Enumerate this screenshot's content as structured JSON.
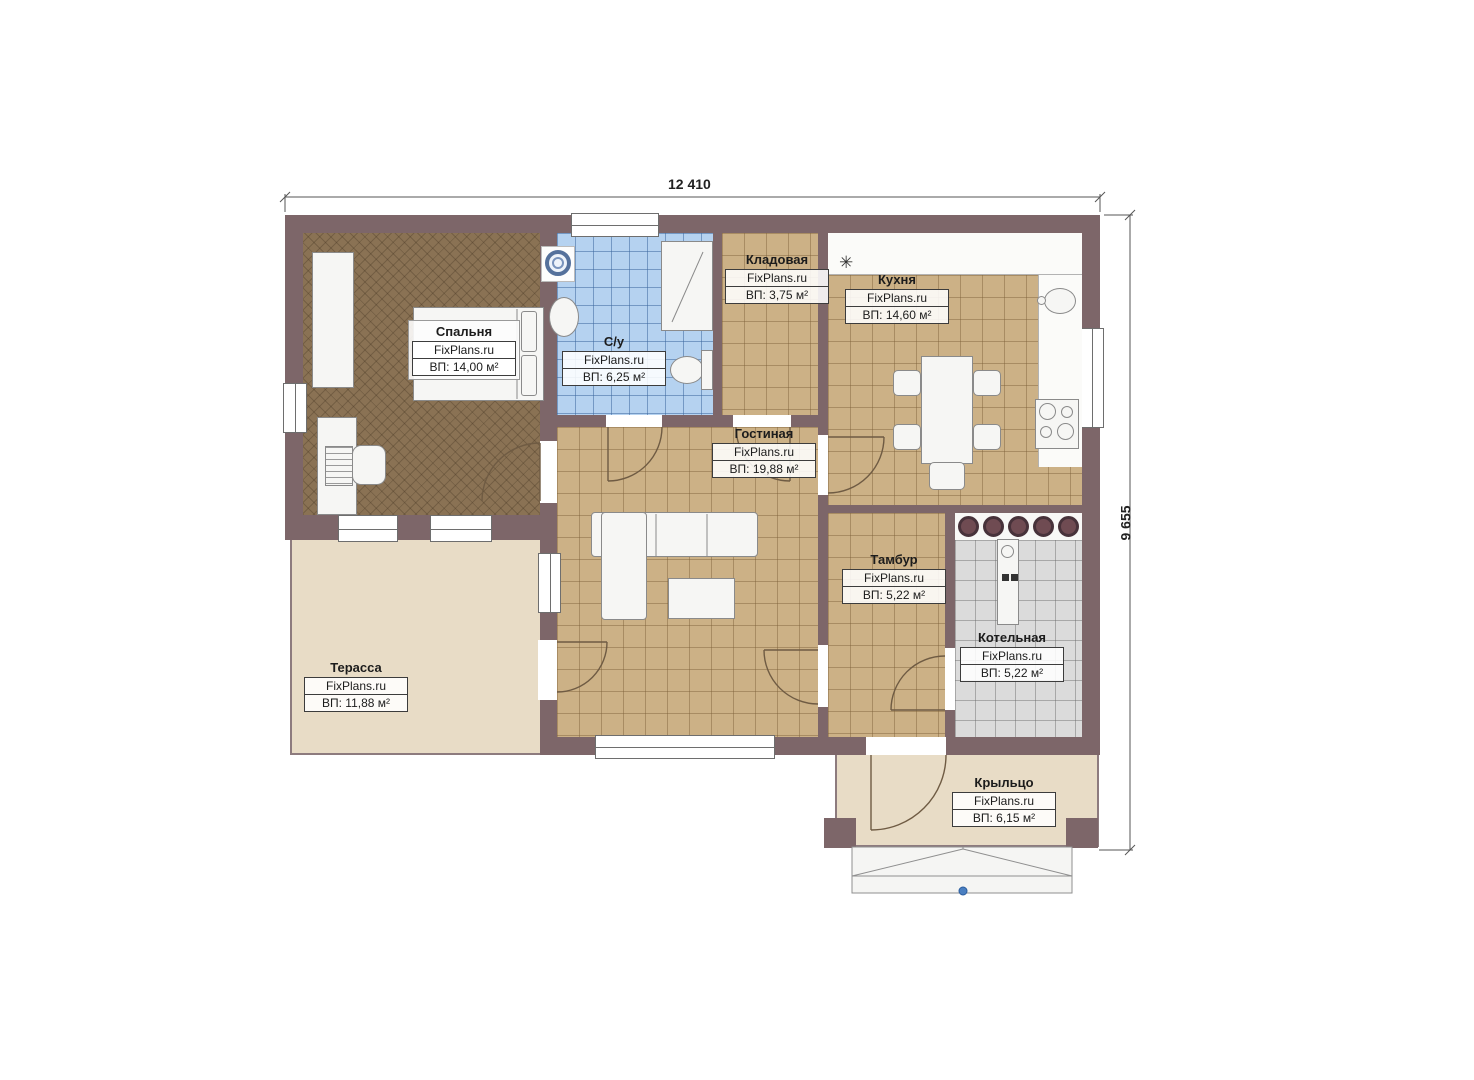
{
  "plan": {
    "dimensions": {
      "width": "12 410",
      "height": "9 655"
    },
    "watermark": "FixPlans.ru",
    "rooms": [
      {
        "id": "bedroom",
        "name": "Спальня",
        "watermark": "FixPlans.ru",
        "area": "ВП: 14,00 м²"
      },
      {
        "id": "bathroom",
        "name": "С/у",
        "watermark": "FixPlans.ru",
        "area": "ВП: 6,25 м²"
      },
      {
        "id": "storage",
        "name": "Кладовая",
        "watermark": "FixPlans.ru",
        "area": "ВП: 3,75 м²"
      },
      {
        "id": "kitchen",
        "name": "Кухня",
        "watermark": "FixPlans.ru",
        "area": "ВП: 14,60 м²"
      },
      {
        "id": "living",
        "name": "Гостиная",
        "watermark": "FixPlans.ru",
        "area": "ВП: 19,88 м²"
      },
      {
        "id": "vestibule",
        "name": "Тамбур",
        "watermark": "FixPlans.ru",
        "area": "ВП: 5,22 м²"
      },
      {
        "id": "boiler",
        "name": "Котельная",
        "watermark": "FixPlans.ru",
        "area": "ВП: 5,22 м²"
      },
      {
        "id": "terrace",
        "name": "Терасса",
        "watermark": "FixPlans.ru",
        "area": "ВП: 11,88 м²"
      },
      {
        "id": "porch",
        "name": "Крыльцо",
        "watermark": "FixPlans.ru",
        "area": "ВП: 6,15 м²"
      }
    ],
    "icons": {
      "fridge_mark": "✳"
    },
    "colors": {
      "wall": "#7d6669",
      "floor_wood": "#8a7254",
      "floor_tile_tan": "#ccb186",
      "floor_tile_blue": "#b5d2f0",
      "floor_tile_gray": "#dbdbdb",
      "outdoor": "#e8dcc6",
      "marker_blue": "#4a7fc1"
    }
  }
}
